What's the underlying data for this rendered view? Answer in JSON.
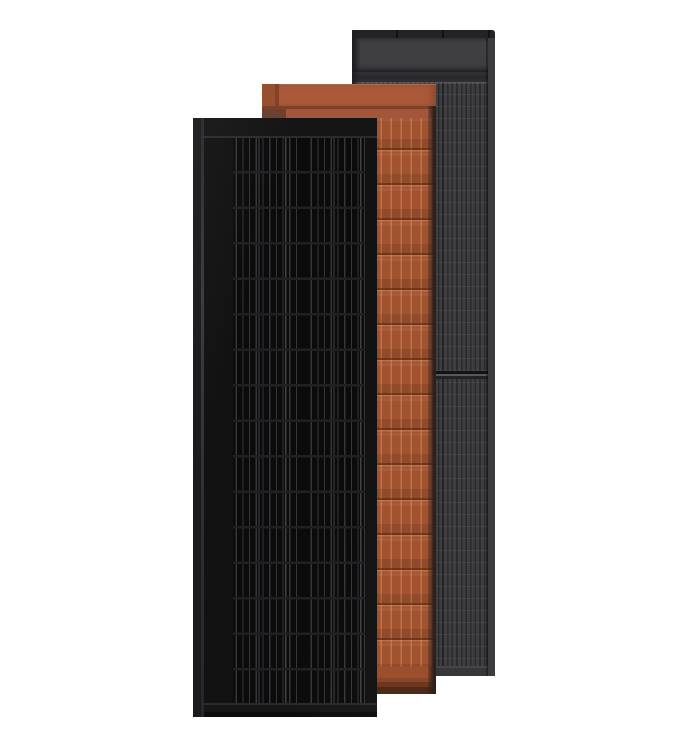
{
  "scene": {
    "background": "#ffffff",
    "subject": "three overlapping solar roof panels product render"
  },
  "panels": [
    {
      "key": "graphite-gray",
      "depth": "back",
      "colors": {
        "top_strip": "#232325",
        "band": "#3f3f41",
        "divider": "#28282a",
        "cell_base": "#2b2b2d",
        "cell_stripe": "#3e3e42",
        "module_line": "#58585c",
        "bottom": "#373739",
        "edge_left": "#1e1e20",
        "edge_right": "#3c3c3e"
      }
    },
    {
      "key": "terracotta",
      "depth": "middle",
      "colors": {
        "band": "#aa5939",
        "band_shade": "#96502f",
        "groove": "#7e4026",
        "subband": "#a3563a",
        "tab": "#6d4034",
        "cell_base": "#a1532f",
        "foot": "#9c4f2d",
        "foot_dark": "#4e2918",
        "side": "#2d1f19"
      }
    },
    {
      "key": "matte-black",
      "depth": "front",
      "colors": {
        "frame": "#121212",
        "top_band": "#151515",
        "top_line": "#2c2c2e",
        "cell_base": "#0b0b0b",
        "cell_stripe": "#35353a",
        "row_line": "#202022",
        "bottom": "#161616",
        "bottom_line": "#2a2a2c",
        "edge": "#1a1a1c",
        "edge_line": "#404046"
      }
    }
  ]
}
